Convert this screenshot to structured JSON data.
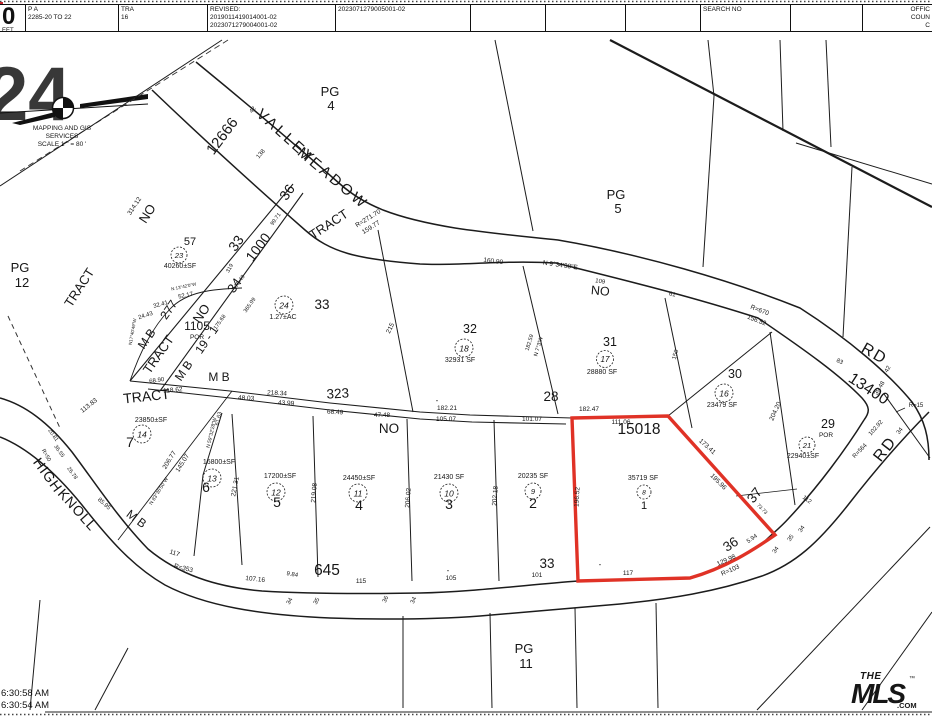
{
  "header": {
    "sheet_big": "0",
    "sheet_small": "EET",
    "pa_label": "P A",
    "pa_value": "2285-20 TO 22",
    "tra_label": "TRA",
    "tra_value": "16",
    "revised_label": "REVISED:",
    "revised_1": "2019011419014001-02",
    "revised_2": "2023071279004001-02",
    "doc_no": "2023071279005001-02",
    "search_label": "SEARCH NO",
    "office_lines": [
      "OFFIC",
      "COUN",
      "C"
    ]
  },
  "compass": {
    "line1": "MAPPING AND GIS",
    "line2": "SERVICES",
    "line3": "SCALE 1 \" = 80 '"
  },
  "watermark": "24",
  "footer": {
    "time1": "6:30:58 AM",
    "time2": "6:30:54 AM"
  },
  "logo": {
    "the": "THE",
    "mls": "MLS",
    "com": ".COM",
    "tm": "™",
    "color": "#e8192c"
  },
  "map": {
    "highlight_color": "#e03226",
    "highlighted_parcel": {
      "tract": "15018",
      "lot": "1",
      "area": "35719 SF"
    },
    "labels": [
      {
        "t": "MAPPING AND GIS",
        "x": 62,
        "y": 130,
        "s": 6.5
      },
      {
        "t": "SERVICES",
        "x": 62,
        "y": 138,
        "s": 6.5
      },
      {
        "t": "SCALE 1 \" = 80 '",
        "x": 62,
        "y": 146,
        "s": 6.5
      },
      {
        "t": "PG",
        "x": 20,
        "y": 272,
        "s": 13
      },
      {
        "t": "12",
        "x": 22,
        "y": 287,
        "s": 13
      },
      {
        "t": "TRACT",
        "x": 83,
        "y": 290,
        "r": -57,
        "s": 13
      },
      {
        "t": "NO",
        "x": 151,
        "y": 216,
        "r": -57,
        "s": 13
      },
      {
        "t": "314.12",
        "x": 136,
        "y": 207,
        "r": -57,
        "s": 6.5
      },
      {
        "t": "12666",
        "x": 226,
        "y": 139,
        "r": -53,
        "s": 15
      },
      {
        "t": "42",
        "x": 254,
        "y": 111,
        "r": -50,
        "s": 6
      },
      {
        "t": "138",
        "x": 262,
        "y": 155,
        "r": -50,
        "s": 6
      },
      {
        "t": "VALLEY",
        "x": 283,
        "y": 140,
        "r": 42,
        "s": 15,
        "ls": 3
      },
      {
        "t": "MEADOW",
        "x": 330,
        "y": 182,
        "r": 40,
        "s": 15,
        "ls": 3
      },
      {
        "t": "PG",
        "x": 330,
        "y": 96,
        "s": 13
      },
      {
        "t": "4",
        "x": 331,
        "y": 110,
        "s": 13
      },
      {
        "t": "TRACT",
        "x": 331,
        "y": 228,
        "r": -33,
        "s": 13
      },
      {
        "t": "R=271.70",
        "x": 369,
        "y": 220,
        "r": -32,
        "s": 6.5
      },
      {
        "t": "159.77",
        "x": 372,
        "y": 229,
        "r": -32,
        "s": 6.5
      },
      {
        "t": "57",
        "x": 190,
        "y": 245,
        "s": 11
      },
      {
        "t": "40260±SF",
        "x": 180,
        "y": 268,
        "s": 7
      },
      {
        "t": "36",
        "x": 291,
        "y": 195,
        "r": -55,
        "s": 14
      },
      {
        "t": "99.71",
        "x": 277,
        "y": 220,
        "r": -55,
        "s": 5.5
      },
      {
        "t": "1000",
        "x": 262,
        "y": 250,
        "r": -53,
        "s": 14
      },
      {
        "t": "33",
        "x": 240,
        "y": 246,
        "r": -55,
        "s": 14
      },
      {
        "t": "34",
        "x": 238,
        "y": 288,
        "r": -55,
        "s": 13
      },
      {
        "t": "319",
        "x": 231,
        "y": 269,
        "r": -60,
        "s": 5.5
      },
      {
        "t": "75.49",
        "x": 241,
        "y": 282,
        "r": -55,
        "s": 5.5
      },
      {
        "t": "365.99",
        "x": 251,
        "y": 306,
        "r": -55,
        "s": 5.5
      },
      {
        "t": "175.68",
        "x": 221,
        "y": 323,
        "r": -55,
        "s": 5.5
      },
      {
        "t": "52.17",
        "x": 186,
        "y": 297,
        "r": -12,
        "s": 6
      },
      {
        "t": "32.41",
        "x": 161,
        "y": 306,
        "r": -15,
        "s": 6
      },
      {
        "t": "24.43",
        "x": 146,
        "y": 317,
        "r": -18,
        "s": 6
      },
      {
        "t": "N 13°42'0\"W",
        "x": 184,
        "y": 288,
        "r": -12,
        "s": 4.5
      },
      {
        "t": "N17°40'49\"W",
        "x": 134,
        "y": 332,
        "r": -80,
        "s": 4.5
      },
      {
        "t": "M B",
        "x": 150,
        "y": 341,
        "r": -55,
        "s": 12
      },
      {
        "t": "277",
        "x": 172,
        "y": 312,
        "r": -55,
        "s": 12
      },
      {
        "t": "TRACT",
        "x": 162,
        "y": 357,
        "r": -55,
        "s": 13
      },
      {
        "t": "NO",
        "x": 205,
        "y": 316,
        "r": -55,
        "s": 13
      },
      {
        "t": "1105",
        "x": 197,
        "y": 330,
        "s": 12
      },
      {
        "t": "POR",
        "x": 197,
        "y": 339,
        "s": 6.5
      },
      {
        "t": "19 - 1",
        "x": 210,
        "y": 342,
        "r": -55,
        "s": 12
      },
      {
        "t": "M B",
        "x": 187,
        "y": 373,
        "r": -55,
        "s": 12
      },
      {
        "t": "M B",
        "x": 219,
        "y": 381,
        "s": 12
      },
      {
        "t": "TRACT",
        "x": 147,
        "y": 401,
        "r": -6,
        "s": 14
      },
      {
        "t": "68.90",
        "x": 157,
        "y": 382,
        "r": -8,
        "s": 6
      },
      {
        "t": "118.62",
        "x": 173,
        "y": 392,
        "r": -5,
        "s": 6.5
      },
      {
        "t": "113.83",
        "x": 90,
        "y": 407,
        "r": -38,
        "s": 6.5
      },
      {
        "t": "218.34",
        "x": 277,
        "y": 395,
        "r": 3,
        "s": 6.5
      },
      {
        "t": "48.03",
        "x": 246,
        "y": 400,
        "r": 3,
        "s": 6.5
      },
      {
        "t": "43.99",
        "x": 286,
        "y": 405,
        "r": 3,
        "s": 6.5
      },
      {
        "t": "323",
        "x": 338,
        "y": 398,
        "r": -3,
        "s": 13.5
      },
      {
        "t": "68.49",
        "x": 335,
        "y": 414,
        "r": 3,
        "s": 6.5
      },
      {
        "t": "NO",
        "x": 389,
        "y": 433,
        "s": 13.5
      },
      {
        "t": "47.48",
        "x": 382,
        "y": 417,
        "s": 6.5
      },
      {
        "t": "105.07",
        "x": 446,
        "y": 421,
        "s": 6.5
      },
      {
        "t": "101.07",
        "x": 532,
        "y": 421,
        "s": 6.5
      },
      {
        "t": "182.21",
        "x": 447,
        "y": 410,
        "s": 6.5
      },
      {
        "t": "-",
        "x": 437,
        "y": 403,
        "s": 8
      },
      {
        "t": "28",
        "x": 551,
        "y": 401,
        "s": 13.5
      },
      {
        "t": "182.47",
        "x": 589,
        "y": 411,
        "s": 6.5
      },
      {
        "t": "33",
        "x": 322,
        "y": 309,
        "s": 13.5
      },
      {
        "t": "215",
        "x": 392,
        "y": 329,
        "r": -64,
        "s": 6.5
      },
      {
        "t": "1.27±AC",
        "x": 283,
        "y": 319,
        "s": 7
      },
      {
        "t": "32",
        "x": 470,
        "y": 333,
        "s": 12.5
      },
      {
        "t": "32931 SF",
        "x": 460,
        "y": 362,
        "s": 7
      },
      {
        "t": "182.59",
        "x": 531,
        "y": 343,
        "r": -73,
        "s": 5.5
      },
      {
        "t": "N 7°3'W",
        "x": 540,
        "y": 347,
        "r": -73,
        "s": 5.5
      },
      {
        "t": "160.90",
        "x": 493,
        "y": 263,
        "r": 7,
        "s": 6.5
      },
      {
        "t": "N 9°34'38\"E",
        "x": 560,
        "y": 267,
        "r": 8,
        "s": 6.5
      },
      {
        "t": "109",
        "x": 600,
        "y": 283,
        "r": 8,
        "s": 6
      },
      {
        "t": "NO",
        "x": 600,
        "y": 295,
        "r": 5,
        "s": 12.5
      },
      {
        "t": "61",
        "x": 672,
        "y": 296,
        "r": 10,
        "s": 6
      },
      {
        "t": "31",
        "x": 610,
        "y": 346,
        "s": 12.5
      },
      {
        "t": "28880 SF",
        "x": 602,
        "y": 374,
        "s": 7
      },
      {
        "t": "150",
        "x": 677,
        "y": 355,
        "r": -74,
        "s": 6
      },
      {
        "t": "PG",
        "x": 616,
        "y": 199,
        "s": 13
      },
      {
        "t": "5",
        "x": 618,
        "y": 213,
        "s": 13
      },
      {
        "t": "R=670",
        "x": 759,
        "y": 312,
        "r": 21,
        "s": 6.5
      },
      {
        "t": "156.52",
        "x": 756,
        "y": 322,
        "r": 21,
        "s": 6.5
      },
      {
        "t": "RD",
        "x": 872,
        "y": 358,
        "r": 30,
        "s": 16,
        "ls": 2
      },
      {
        "t": "13400",
        "x": 866,
        "y": 393,
        "r": 33,
        "s": 16
      },
      {
        "t": "83",
        "x": 839,
        "y": 363,
        "r": 25,
        "s": 6
      },
      {
        "t": "42",
        "x": 889,
        "y": 370,
        "r": -60,
        "s": 6
      },
      {
        "t": "39.48",
        "x": 881,
        "y": 389,
        "r": -60,
        "s": 6
      },
      {
        "t": "R=15",
        "x": 916,
        "y": 407,
        "s": 6
      },
      {
        "t": "102.92",
        "x": 877,
        "y": 429,
        "r": -48,
        "s": 6
      },
      {
        "t": "R=564",
        "x": 861,
        "y": 452,
        "r": -46,
        "s": 6
      },
      {
        "t": "RD",
        "x": 889,
        "y": 452,
        "r": -52,
        "s": 16,
        "ls": 2
      },
      {
        "t": "34",
        "x": 901,
        "y": 432,
        "r": -52,
        "s": 6
      },
      {
        "t": "30",
        "x": 735,
        "y": 378,
        "s": 12.5
      },
      {
        "t": "23479 SF",
        "x": 722,
        "y": 407,
        "s": 7
      },
      {
        "t": "204.20",
        "x": 777,
        "y": 412,
        "r": -66,
        "s": 6.5
      },
      {
        "t": "29",
        "x": 828,
        "y": 428,
        "s": 12.5
      },
      {
        "t": "POR",
        "x": 826,
        "y": 437,
        "s": 6.5
      },
      {
        "t": "22940±SF",
        "x": 803,
        "y": 458,
        "s": 7
      },
      {
        "t": "15018",
        "x": 639,
        "y": 434,
        "s": 15.5
      },
      {
        "t": "111.06",
        "x": 621,
        "y": 424,
        "s": 6.5
      },
      {
        "t": "35719 SF",
        "x": 643,
        "y": 480,
        "s": 7
      },
      {
        "t": "1",
        "x": 644,
        "y": 509,
        "s": 11
      },
      {
        "t": "196.52",
        "x": 579,
        "y": 497,
        "r": -87,
        "s": 6.5
      },
      {
        "t": "173.41",
        "x": 706,
        "y": 448,
        "r": 42,
        "s": 6.5
      },
      {
        "t": "195.96",
        "x": 717,
        "y": 483,
        "r": 45,
        "s": 6.5
      },
      {
        "t": "117",
        "x": 628,
        "y": 575,
        "s": 6.5
      },
      {
        "t": "-",
        "x": 600,
        "y": 567,
        "s": 8
      },
      {
        "t": "37",
        "x": 758,
        "y": 498,
        "r": -52,
        "s": 13.5
      },
      {
        "t": "73.73",
        "x": 761,
        "y": 510,
        "r": 45,
        "s": 5
      },
      {
        "t": "36",
        "x": 733,
        "y": 548,
        "r": -33,
        "s": 13.5
      },
      {
        "t": "5.94",
        "x": 753,
        "y": 540,
        "r": -35,
        "s": 6
      },
      {
        "t": "129.98",
        "x": 727,
        "y": 562,
        "r": -24,
        "s": 6.5
      },
      {
        "t": "R=103",
        "x": 731,
        "y": 572,
        "r": -24,
        "s": 6.5
      },
      {
        "t": "112",
        "x": 806,
        "y": 501,
        "r": 36,
        "s": 6
      },
      {
        "t": "34",
        "x": 803,
        "y": 530,
        "r": -55,
        "s": 6
      },
      {
        "t": "35",
        "x": 792,
        "y": 539,
        "r": -55,
        "s": 6
      },
      {
        "t": "34",
        "x": 777,
        "y": 551,
        "r": -55,
        "s": 6
      },
      {
        "t": "33",
        "x": 547,
        "y": 568,
        "s": 13.5
      },
      {
        "t": "101",
        "x": 537,
        "y": 577,
        "s": 6.5
      },
      {
        "t": "105",
        "x": 451,
        "y": 580,
        "s": 6.5
      },
      {
        "t": "-",
        "x": 448,
        "y": 573,
        "s": 8
      },
      {
        "t": "115",
        "x": 361,
        "y": 583,
        "s": 6.5
      },
      {
        "t": "645",
        "x": 327,
        "y": 575,
        "s": 15.5
      },
      {
        "t": "9.84",
        "x": 292,
        "y": 576,
        "r": 10,
        "s": 6
      },
      {
        "t": "107.16",
        "x": 255,
        "y": 581,
        "r": 6,
        "s": 6.5
      },
      {
        "t": "R=353",
        "x": 183,
        "y": 570,
        "r": 14,
        "s": 6.5
      },
      {
        "t": "117",
        "x": 174,
        "y": 555,
        "r": 18,
        "s": 6.5
      },
      {
        "t": "34",
        "x": 291,
        "y": 602,
        "r": -60,
        "s": 6
      },
      {
        "t": "35",
        "x": 318,
        "y": 602,
        "r": -60,
        "s": 6
      },
      {
        "t": "36",
        "x": 387,
        "y": 600,
        "r": -65,
        "s": 6
      },
      {
        "t": "34",
        "x": 415,
        "y": 601,
        "r": -65,
        "s": 6
      },
      {
        "t": "HIGH",
        "x": 44,
        "y": 478,
        "r": 54,
        "s": 14,
        "ls": 1
      },
      {
        "t": "KNOLL",
        "x": 74,
        "y": 513,
        "r": 48,
        "s": 14,
        "ls": 1
      },
      {
        "t": "M B",
        "x": 134,
        "y": 522,
        "r": 37,
        "s": 12
      },
      {
        "t": "R=50",
        "x": 45,
        "y": 456,
        "r": 60,
        "s": 5.5
      },
      {
        "t": "36.55",
        "x": 58,
        "y": 452,
        "r": 55,
        "s": 5.5
      },
      {
        "t": "20.81",
        "x": 52,
        "y": 436,
        "r": 55,
        "s": 5.5
      },
      {
        "t": "26.78",
        "x": 71,
        "y": 474,
        "r": 55,
        "s": 5.5
      },
      {
        "t": "85.95",
        "x": 103,
        "y": 505,
        "r": 42,
        "s": 6
      },
      {
        "t": "206.77",
        "x": 171,
        "y": 461,
        "r": -58,
        "s": 6.5
      },
      {
        "t": "145.07",
        "x": 184,
        "y": 464,
        "r": -58,
        "s": 6.5
      },
      {
        "t": "N 83°36'50\"W",
        "x": 160,
        "y": 492,
        "r": -58,
        "s": 5
      },
      {
        "t": "N 59°32'28\"W",
        "x": 213,
        "y": 433,
        "r": -77,
        "s": 5
      },
      {
        "t": "61.63",
        "x": 220,
        "y": 419,
        "r": -77,
        "s": 5.5
      },
      {
        "t": "23850±SF",
        "x": 151,
        "y": 422,
        "s": 7
      },
      {
        "t": "7",
        "x": 130,
        "y": 447,
        "s": 14
      },
      {
        "t": "16800±SF",
        "x": 219,
        "y": 464,
        "s": 7
      },
      {
        "t": "6",
        "x": 206,
        "y": 492,
        "s": 14
      },
      {
        "t": "221.31",
        "x": 237,
        "y": 487,
        "r": -79,
        "s": 6.5
      },
      {
        "t": "17200±SF",
        "x": 280,
        "y": 478,
        "s": 7
      },
      {
        "t": "5",
        "x": 277,
        "y": 507,
        "s": 14
      },
      {
        "t": "24450±SF",
        "x": 359,
        "y": 480,
        "s": 7
      },
      {
        "t": "4",
        "x": 359,
        "y": 510,
        "s": 14
      },
      {
        "t": "219.08",
        "x": 316,
        "y": 493,
        "r": -86,
        "s": 6.5
      },
      {
        "t": "206.02",
        "x": 410,
        "y": 498,
        "r": -86,
        "s": 6.5
      },
      {
        "t": "21430 SF",
        "x": 449,
        "y": 479,
        "s": 7
      },
      {
        "t": "3",
        "x": 449,
        "y": 509,
        "s": 14
      },
      {
        "t": "202.18",
        "x": 497,
        "y": 496,
        "r": -86,
        "s": 6.5
      },
      {
        "t": "20235 SF",
        "x": 533,
        "y": 478,
        "s": 7
      },
      {
        "t": "2",
        "x": 533,
        "y": 508,
        "s": 14
      },
      {
        "t": "PG",
        "x": 524,
        "y": 653,
        "s": 13
      },
      {
        "t": "11",
        "x": 526,
        "y": 668,
        "s": 13
      }
    ],
    "circles": [
      {
        "n": "23",
        "x": 179,
        "y": 255,
        "rad": 8
      },
      {
        "n": "24",
        "x": 284,
        "y": 305,
        "rad": 9
      },
      {
        "n": "18",
        "x": 464,
        "y": 348,
        "rad": 9
      },
      {
        "n": "17",
        "x": 605,
        "y": 359,
        "rad": 8.5
      },
      {
        "n": "16",
        "x": 724,
        "y": 393,
        "rad": 9
      },
      {
        "n": "21",
        "x": 807,
        "y": 445,
        "rad": 8
      },
      {
        "n": "8",
        "x": 644,
        "y": 492,
        "rad": 7
      },
      {
        "n": "14",
        "x": 142,
        "y": 434,
        "rad": 9
      },
      {
        "n": "13",
        "x": 212,
        "y": 478,
        "rad": 9
      },
      {
        "n": "12",
        "x": 276,
        "y": 492,
        "rad": 9
      },
      {
        "n": "11",
        "x": 358,
        "y": 493,
        "rad": 9
      },
      {
        "n": "10",
        "x": 449,
        "y": 493,
        "rad": 9
      },
      {
        "n": "9",
        "x": 533,
        "y": 491,
        "rad": 8
      }
    ]
  }
}
